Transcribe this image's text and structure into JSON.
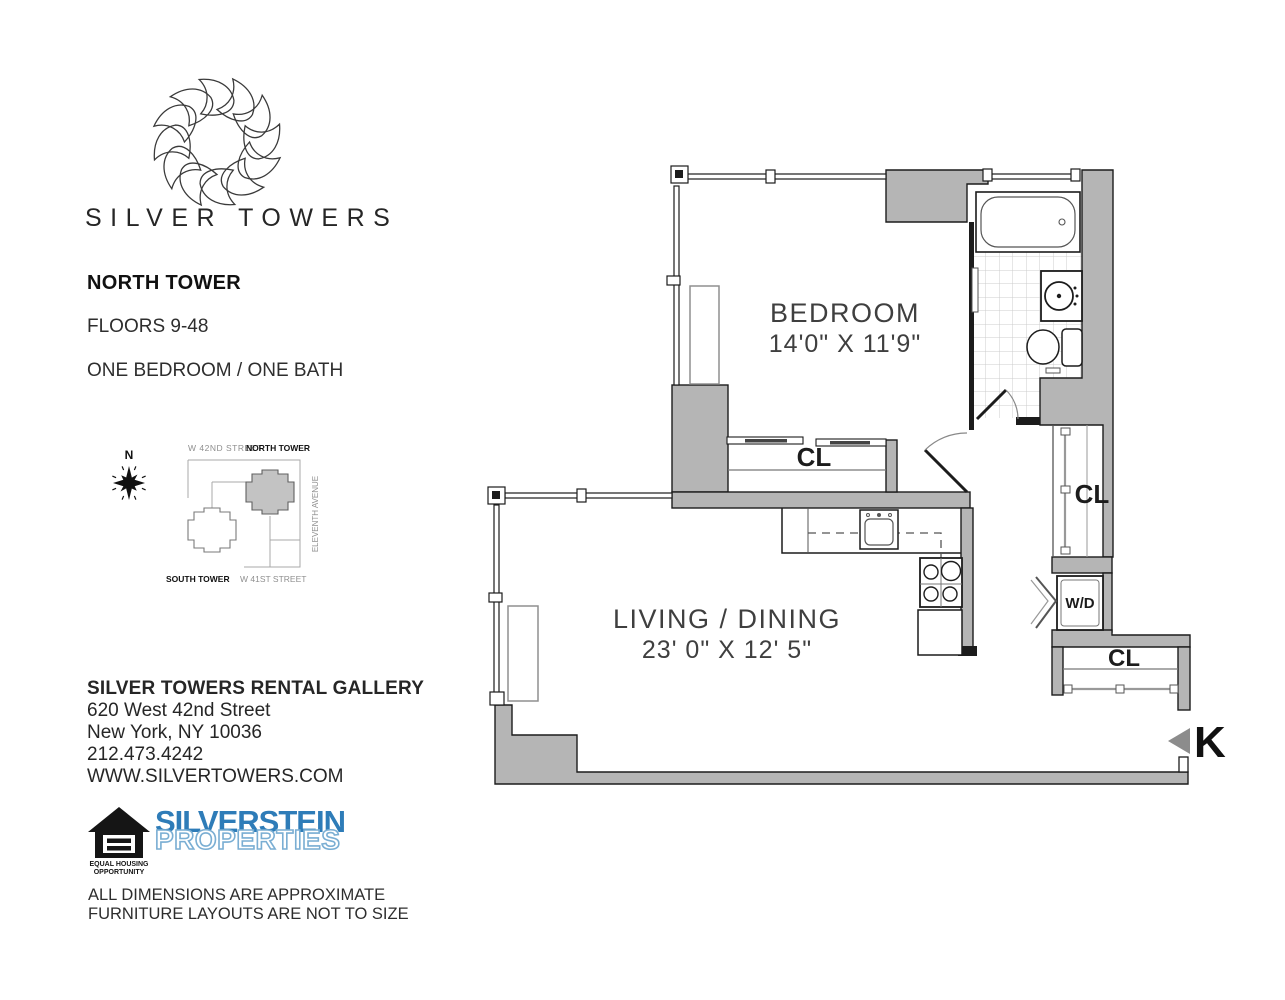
{
  "branding": {
    "name": "SILVER TOWERS",
    "logo": "spirograph-flower-mark"
  },
  "unit_info": {
    "tower": "NORTH TOWER",
    "floors": "FLOORS 9-48",
    "layout": "ONE BEDROOM / ONE BATH"
  },
  "site_map": {
    "compass": "N",
    "street_top": "W 42ND STREET",
    "north_tower": "NORTH TOWER",
    "avenue": "ELEVENTH AVENUE",
    "south_tower": "SOUTH TOWER",
    "street_bottom": "W 41ST STREET"
  },
  "floor_plan": {
    "bedroom": {
      "name": "BEDROOM",
      "dims": "14'0\" X 11'9\""
    },
    "living": {
      "name": "LIVING / DINING",
      "dims": "23' 0\" X 12' 5\""
    },
    "bedroom_closet": "CL",
    "hall_closet": "CL",
    "entry_closet": "CL",
    "washer_dryer": "W/D",
    "line_marker": "K"
  },
  "contact": {
    "name": "SILVER TOWERS RENTAL GALLERY",
    "street": "620 West 42nd Street",
    "city": "New York, NY 10036",
    "phone": "212.473.4242",
    "website": "WWW.SILVERTOWERS.COM"
  },
  "equal_housing": {
    "line1": "EQUAL HOUSING",
    "line2": "OPPORTUNITY"
  },
  "silverstein": {
    "line1": "SILVERSTEIN",
    "line2": "PROPERTIES"
  },
  "disclaimer": {
    "line1": "ALL DIMENSIONS ARE APPROXIMATE",
    "line2": "FURNITURE LAYOUTS ARE NOT TO SIZE"
  },
  "colors": {
    "wall": "#b5b5b5",
    "line": "#1c1c1c",
    "silverstein_blue": "#2e7cb8"
  }
}
